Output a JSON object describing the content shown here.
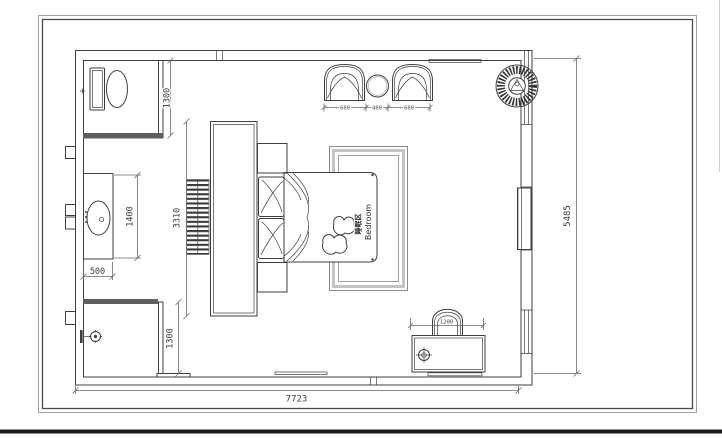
{
  "room_label": {
    "zh": "睡眠区",
    "en": "Bedroom"
  },
  "dimensions": {
    "wc_depth": "1300",
    "vanity_length": "1400",
    "vanity_width": "500",
    "headboard_wall_length": "3310",
    "shower_depth": "1300",
    "armchair_left_width": "600",
    "side_table_width": "400",
    "armchair_right_width": "600",
    "desk_width": "1200",
    "room_height": "5485",
    "room_width": "7723"
  },
  "colors": {
    "line": "#3f3f3f",
    "wall_dark": "#5f5f5f",
    "rug_band": "#c4c4c4",
    "frame_outer": "#a0a0a0",
    "frame_inner": "#4a4a4a",
    "ground_bar": "#1b1b1b"
  }
}
